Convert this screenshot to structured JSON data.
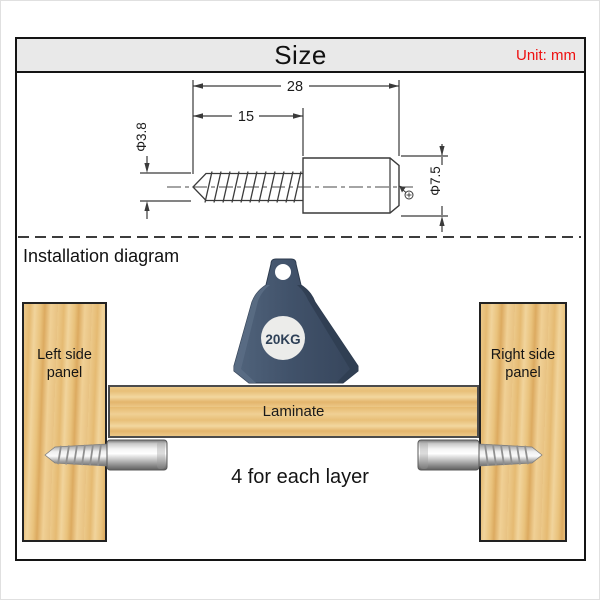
{
  "header": {
    "title": "Size",
    "unit": "Unit: mm"
  },
  "size_diagram": {
    "total_length": "28",
    "thread_length": "15",
    "thread_diameter": "Φ3.8",
    "head_diameter": "Φ7.5",
    "drive_icon": "phillips-drive-icon"
  },
  "installation": {
    "title": "Installation diagram",
    "weight": "20KG",
    "left_panel": {
      "line1": "Left side",
      "line2": "panel"
    },
    "right_panel": {
      "line1": "Right side",
      "line2": "panel"
    },
    "laminate": "Laminate",
    "note": "4 for each layer"
  },
  "colors": {
    "unit_text": "#ee1010",
    "header_bg": "#e9e9e9",
    "drawing_line": "#3a3a3a",
    "weight_body": "#41526a",
    "weight_circle": "#ececea",
    "wood_base": "#ecc98a",
    "metal_light": "#f5f5f5",
    "metal_dark": "#5f5f5f"
  }
}
